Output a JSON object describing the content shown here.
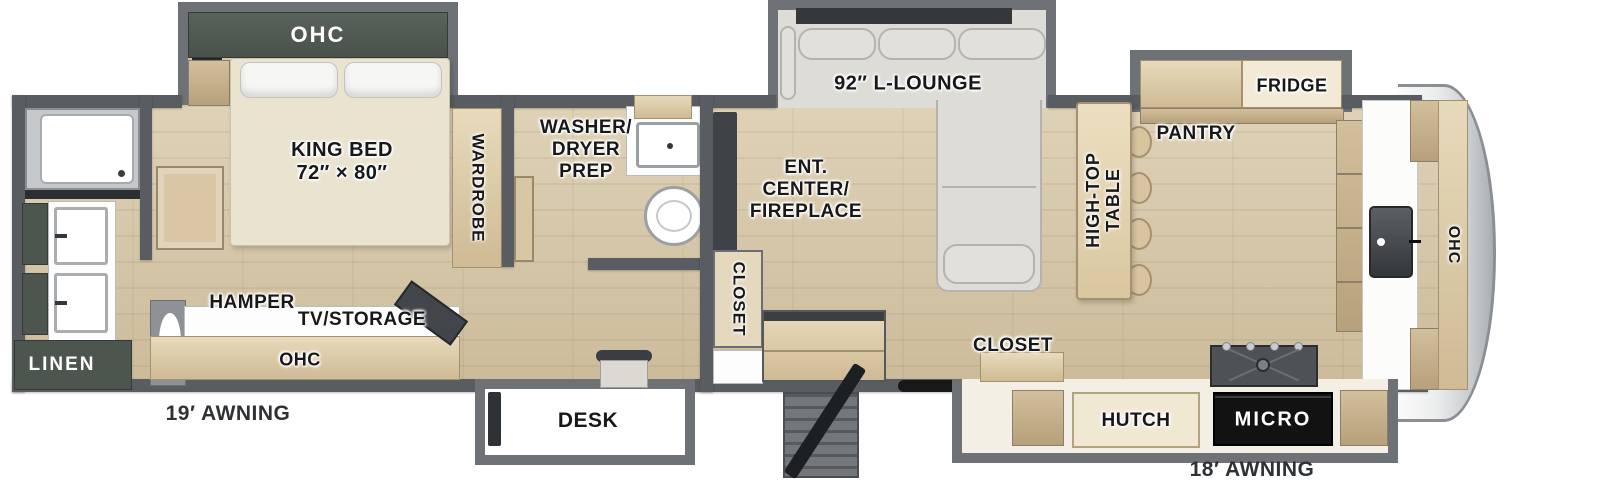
{
  "labels": {
    "bedroom_ohc": "OHC",
    "king_bed": "KING BED\n72″ × 80″",
    "wardrobe": "WARDROBE",
    "washer_dryer_prep": "WASHER/\nDRYER\nPREP",
    "linen": "LINEN",
    "hamper": "HAMPER",
    "tv_storage": "TV/STORAGE",
    "bedroom_lower_ohc": "OHC",
    "awning_left": "19′ AWNING",
    "desk": "DESK",
    "closet_mid": "CLOSET",
    "ent_center": "ENT.\nCENTER/\nFIREPLACE",
    "l_lounge": "92″ L-LOUNGE",
    "high_top_table": "HIGH-TOP\nTABLE",
    "pantry": "PANTRY",
    "fridge": "FRIDGE",
    "closet_kitchen": "CLOSET",
    "hutch": "HUTCH",
    "micro": "MICRO",
    "kitchen_ohc": "OHC",
    "awning_right": "18′ AWNING"
  },
  "colors": {
    "wall": "#595d61",
    "slide_wall": "#6e7276",
    "floor": "#d6c5a3",
    "cabinet_tan": "#d3c09e",
    "cabinet_tan_dark": "#c2ad88",
    "cabinet_green": "#4d564e",
    "sofa": "#dedcd6",
    "bed": "#eae3d0",
    "white_fixture": "#fdfdfd",
    "text_dark": "#17181a",
    "text_white": "#ffffff",
    "micro_bg": "#121212",
    "steps": "#73777b",
    "accent_black": "#1e2124"
  }
}
